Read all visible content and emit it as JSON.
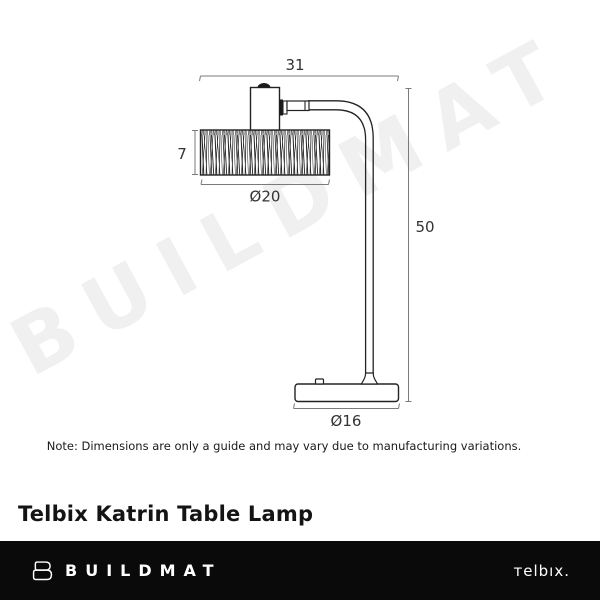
{
  "watermark": "BUILDMAT",
  "diagram": {
    "dims": {
      "width": "31",
      "shade_height": "7",
      "shade_diameter": "Ø20",
      "height": "50",
      "base_diameter": "Ø16"
    }
  },
  "note": "Note: Dimensions are only a guide and may vary due to manufacturing variations.",
  "title": "Telbix Katrin Table Lamp",
  "footer": {
    "buildmat": "BUILDMAT",
    "telbix": "тelbıx."
  },
  "colors": {
    "lamp_line": "#232323",
    "dimension_line": "#7a7a7a",
    "dimension_text": "#333333",
    "watermark": "#f0f0f0",
    "footer_bg": "#0a0a0a",
    "footer_text": "#ffffff"
  }
}
